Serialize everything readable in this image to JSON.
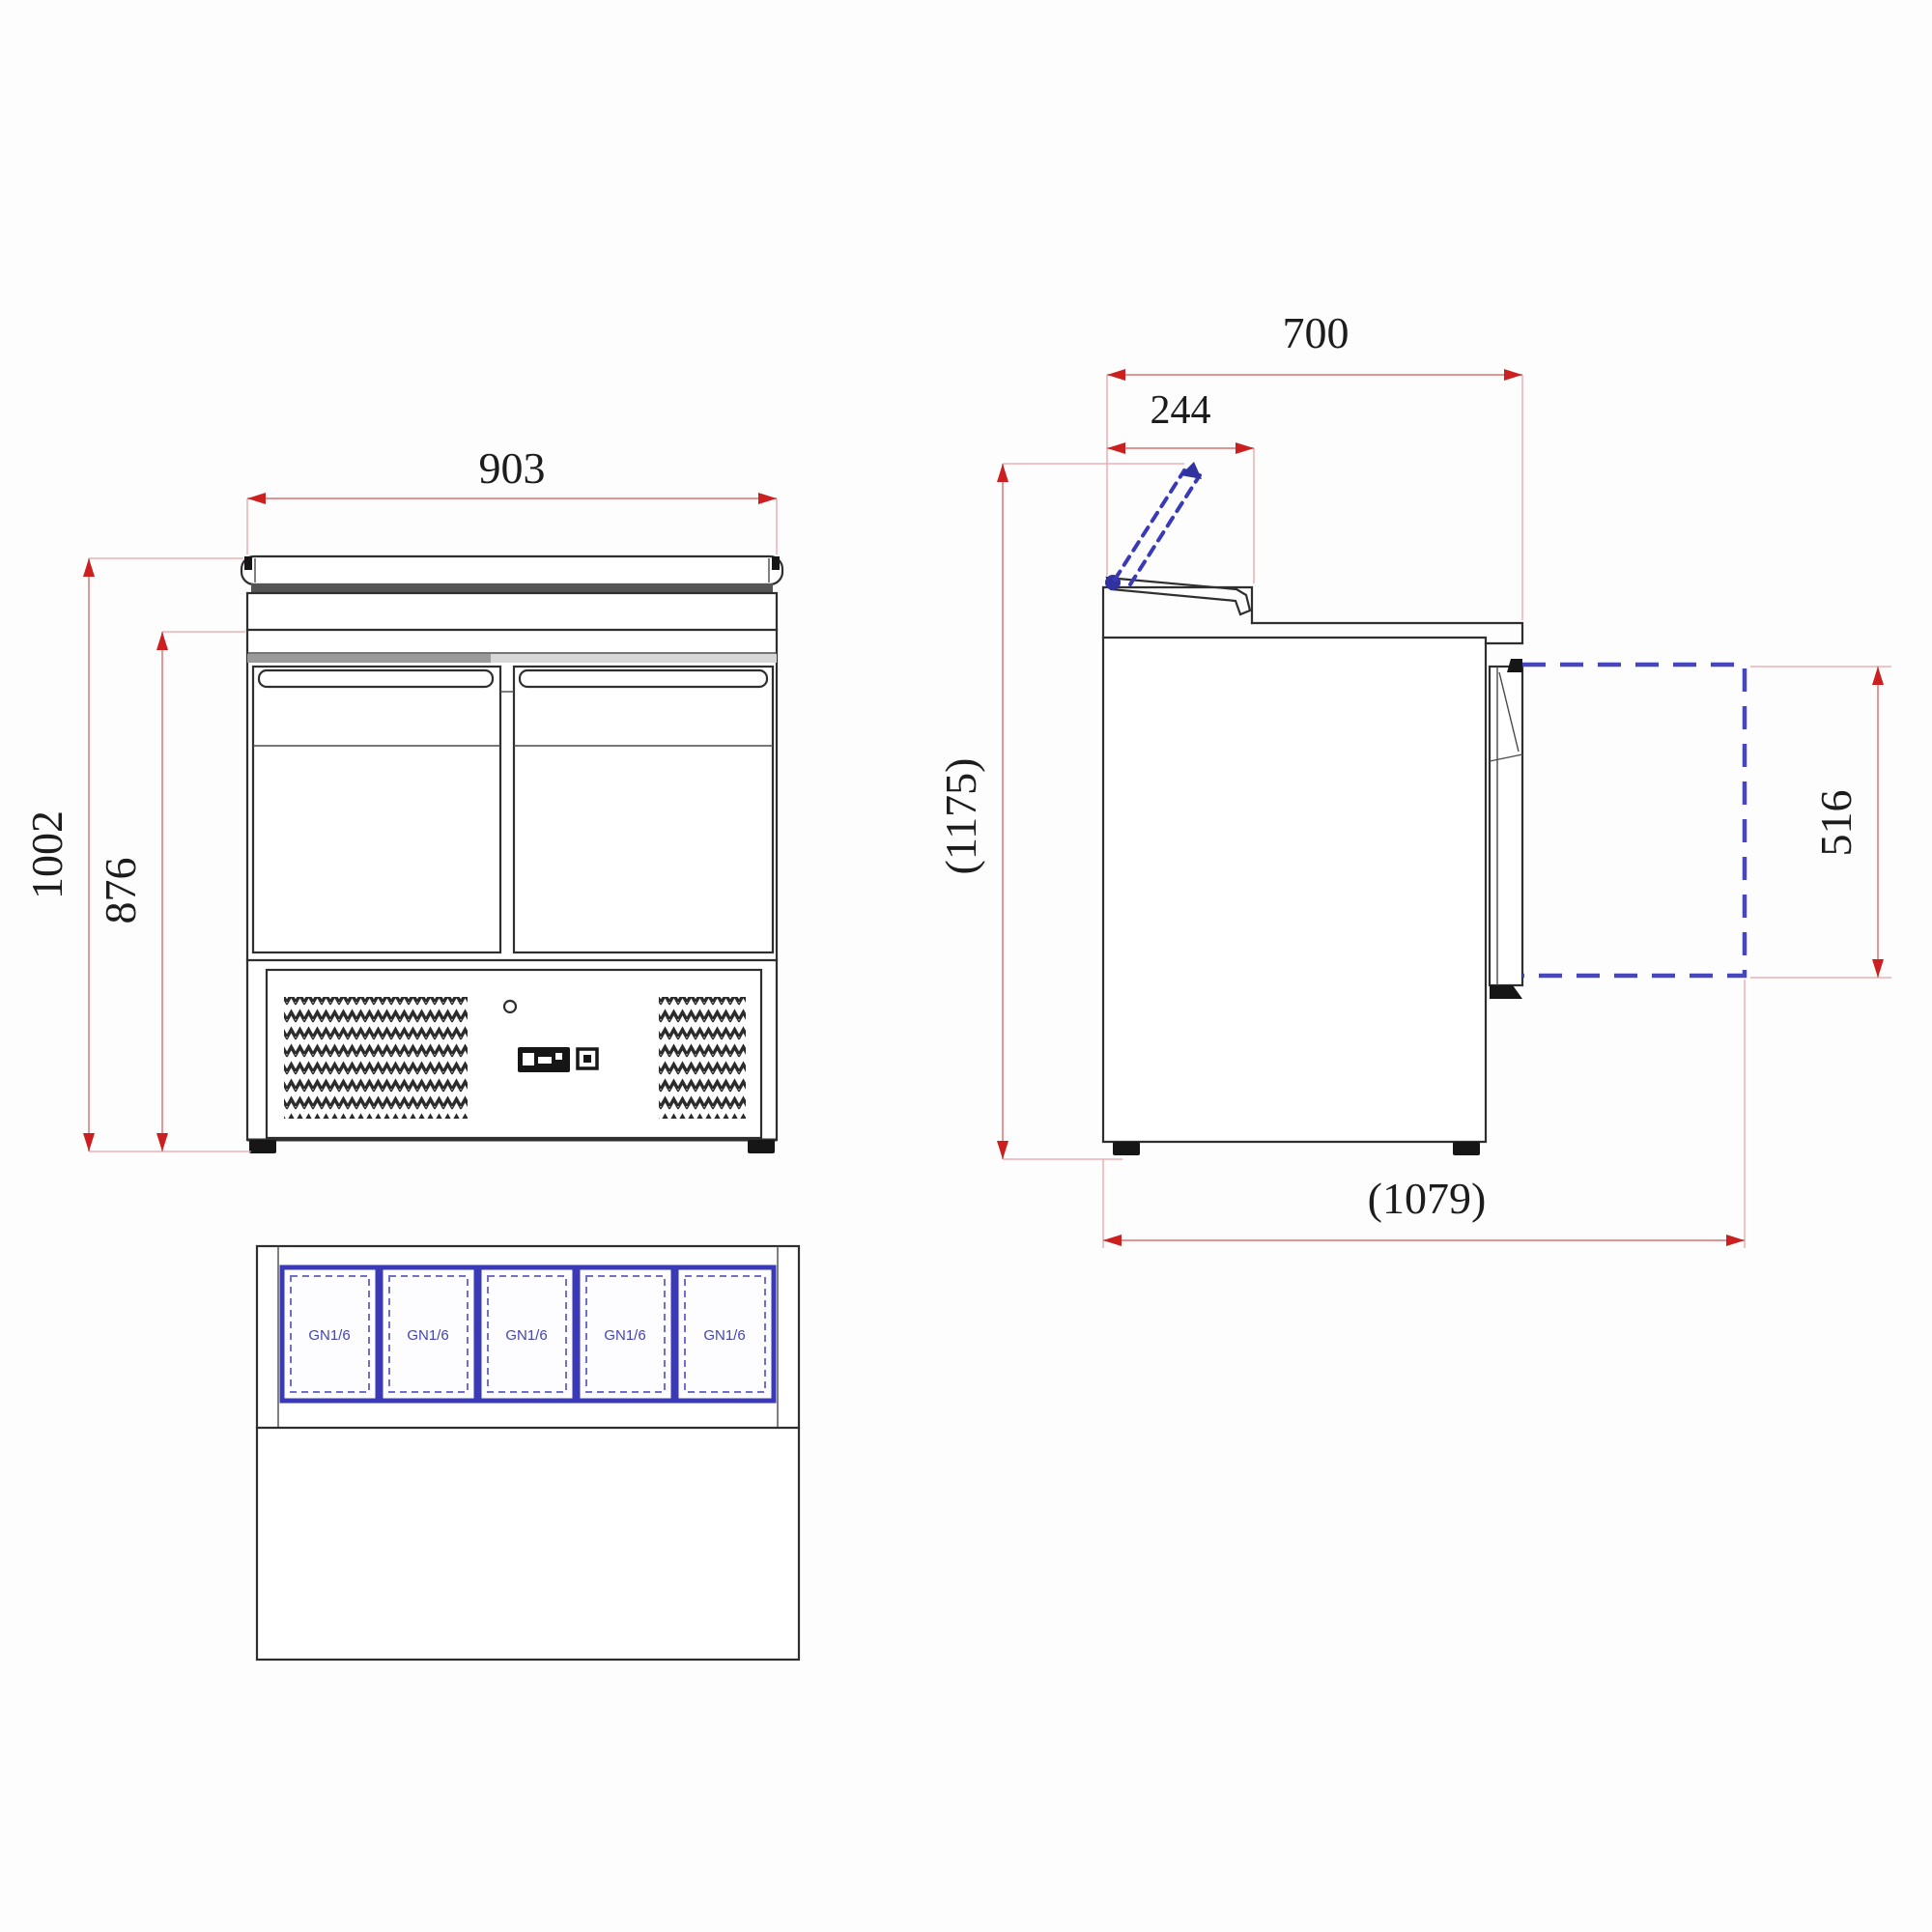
{
  "drawing": {
    "type": "technical-drawing",
    "subject": "two-door refrigerated saladette prep counter, three orthographic views",
    "dimensions": {
      "front_width": "903",
      "front_total_height": "1002",
      "front_body_height": "876",
      "side_depth": "700",
      "side_lid_depth": "244",
      "side_total_height_lid_open": "(1175)",
      "side_door_height": "516",
      "side_total_depth_door_open": "(1079)"
    },
    "plan": {
      "pan_labels": [
        "GN1/6",
        "GN1/6",
        "GN1/6",
        "GN1/6",
        "GN1/6"
      ]
    },
    "colors": {
      "drawing_line": "#2f2f2f",
      "dimension_line": "#e08585",
      "dimension_arrow": "#cc2020",
      "dimension_text": "#1c1c1c",
      "accessory_blue": "#3a3ab8"
    }
  }
}
